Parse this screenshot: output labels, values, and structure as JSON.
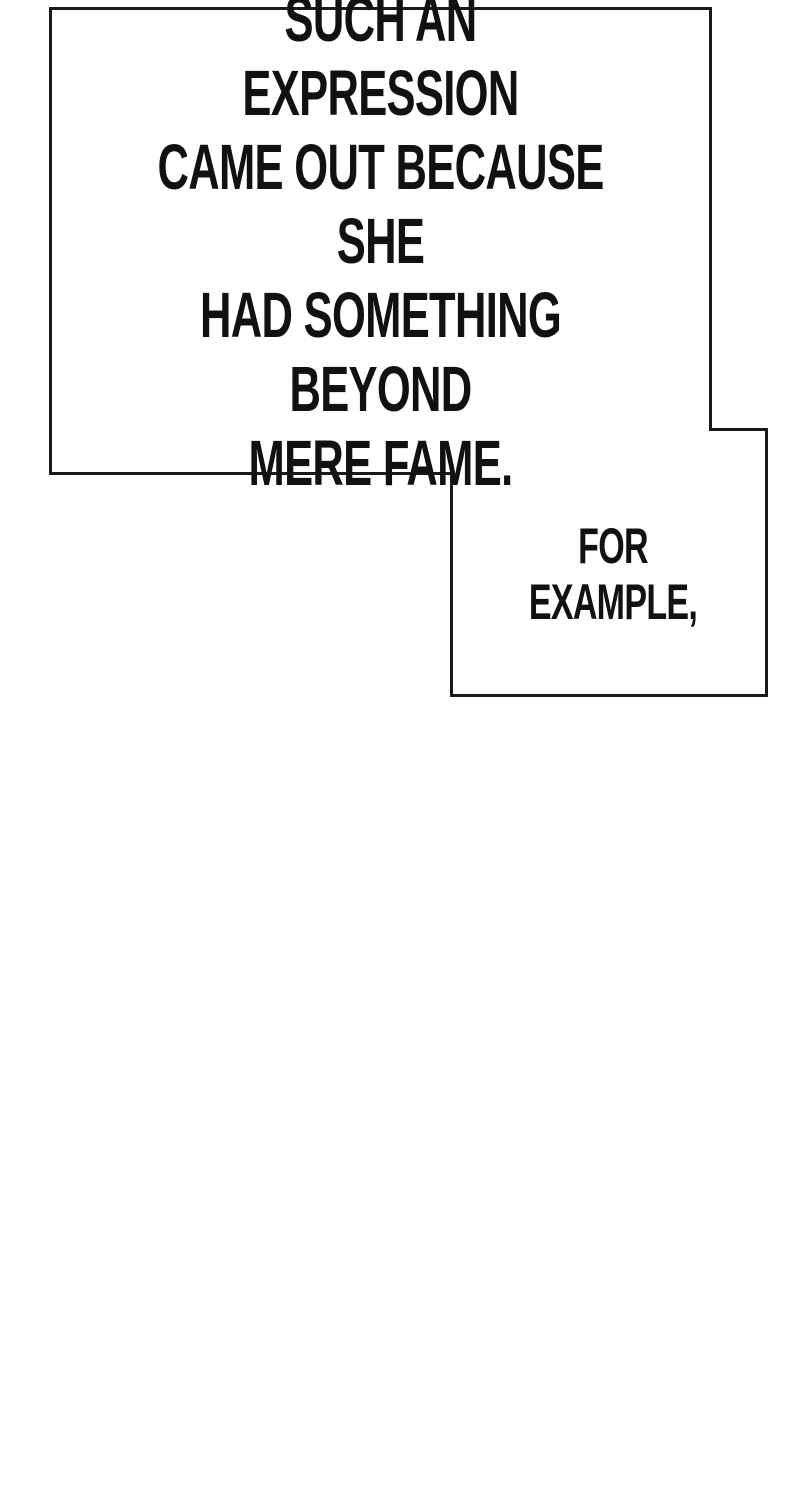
{
  "page": {
    "background_color": "#ffffff",
    "ink_color": "#111111",
    "border_color": "#1a1a1a"
  },
  "panel": {
    "main_caption": "SUCH AN EXPRESSION\nCAME OUT BECAUSE SHE\nHAD SOMETHING BEYOND\nMERE FAME.",
    "example_caption": "FOR EXAMPLE,"
  }
}
